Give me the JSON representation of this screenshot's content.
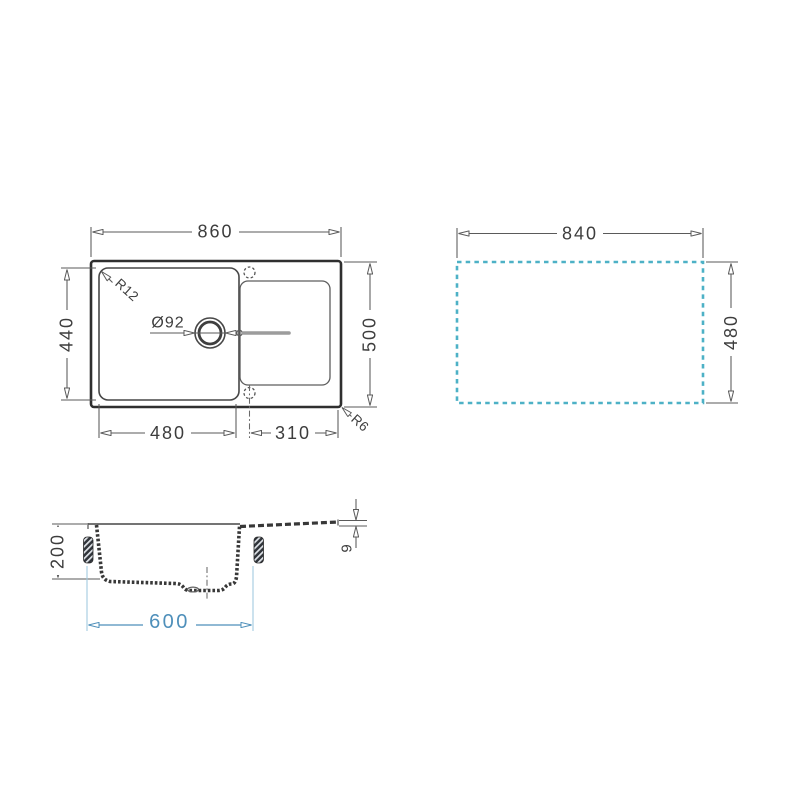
{
  "page": {
    "background": "#ffffff"
  },
  "colors": {
    "line_mid": "#5a5a5a",
    "dim_text": "#3d3d3d",
    "cutout_dash": "#4db1c6",
    "cabinet_dim": "#4e8fba",
    "cabinet_ext": "#a3cbdf",
    "channel_gray": "#9c9c9c"
  },
  "views": {
    "plan": {
      "title": "sink top view",
      "labels": {
        "overall_width": "860",
        "overall_depth": "500",
        "bowl_width": "480",
        "bowl_depth": "440",
        "drainer_width": "310",
        "bowl_corner_radius": "R12",
        "outer_corner_radius": "R6",
        "drain_diameter": "Ø92"
      }
    },
    "cutout": {
      "title": "worktop cutout view",
      "labels": {
        "cutout_width": "840",
        "cutout_depth": "480"
      }
    },
    "section": {
      "title": "cross section view",
      "labels": {
        "bowl_depth": "200",
        "cabinet_width": "600",
        "rim_thickness": "9"
      }
    }
  }
}
